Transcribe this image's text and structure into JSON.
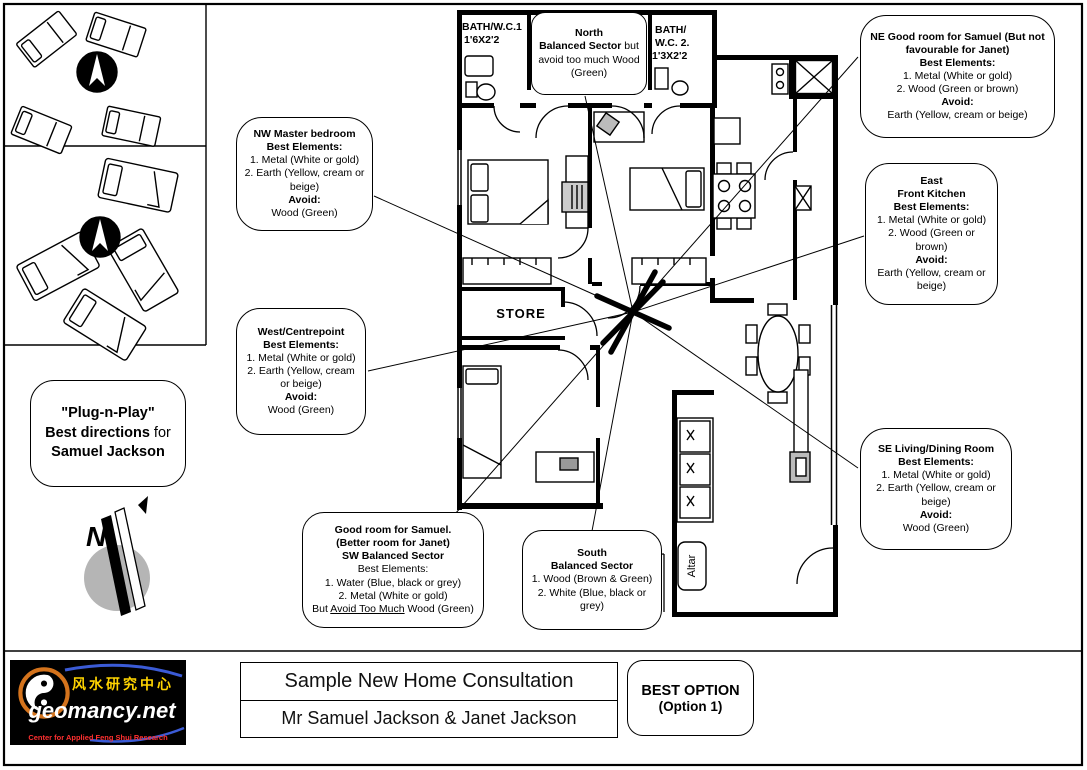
{
  "colors": {
    "line": "#000000",
    "compass_gray": "#b5b5b5",
    "logo_bg": "#000000",
    "logo_yellow": "#ffd400",
    "logo_red": "#ff3030",
    "logo_white": "#ffffff",
    "logo_orange": "#d4731c",
    "logo_blue": "#3b5bd6"
  },
  "left_panel": {
    "plug_quote": "\"Plug-n-Play\"",
    "plug_bold": "Best directions",
    "plug_rest": " for",
    "plug_name": "Samuel Jackson",
    "compass_letter": "N"
  },
  "plan": {
    "bath1_l1": "BATH/W.C.1",
    "bath1_l2": "1'6X2'2",
    "bath2_l1": "BATH/",
    "bath2_l2": "W.C. 2.",
    "bath2_l3": "1'3X2'2",
    "store": "STORE",
    "altar": "Altar"
  },
  "callouts": {
    "nw": {
      "paras": [
        {
          "segs": [
            {
              "t": "NW Master bedroom",
              "b": true
            }
          ]
        },
        {
          "segs": [
            {
              "t": "Best Elements:",
              "b": true
            }
          ]
        },
        {
          "segs": [
            {
              "t": "1. Metal (White or gold)"
            }
          ]
        },
        {
          "segs": [
            {
              "t": "2. Earth (Yellow, cream or beige)"
            }
          ]
        },
        {
          "segs": [
            {
              "t": "Avoid:",
              "b": true
            }
          ]
        },
        {
          "segs": [
            {
              "t": "Wood (Green)"
            }
          ]
        }
      ]
    },
    "north": {
      "paras": [
        {
          "segs": [
            {
              "t": "North",
              "b": true
            }
          ]
        },
        {
          "segs": [
            {
              "t": "Balanced Sector",
              "b": true
            },
            {
              "t": " but avoid too much Wood (Green)"
            }
          ]
        }
      ]
    },
    "ne": {
      "paras": [
        {
          "segs": [
            {
              "t": "NE Good room for Samuel (But not favourable for Janet)",
              "b": true
            }
          ]
        },
        {
          "segs": [
            {
              "t": "Best Elements:",
              "b": true
            }
          ]
        },
        {
          "segs": [
            {
              "t": "1. Metal (White or gold)"
            }
          ]
        },
        {
          "segs": [
            {
              "t": "2. Wood (Green or brown)"
            }
          ]
        },
        {
          "segs": [
            {
              "t": "Avoid:",
              "b": true
            }
          ]
        },
        {
          "segs": [
            {
              "t": "Earth (Yellow, cream or beige)"
            }
          ]
        }
      ]
    },
    "east": {
      "paras": [
        {
          "segs": [
            {
              "t": "East",
              "b": true
            }
          ]
        },
        {
          "segs": [
            {
              "t": "Front Kitchen",
              "b": true
            }
          ]
        },
        {
          "segs": [
            {
              "t": "Best Elements:",
              "b": true
            }
          ]
        },
        {
          "segs": [
            {
              "t": "1. Metal (White or gold)"
            }
          ]
        },
        {
          "segs": [
            {
              "t": "2. Wood (Green or brown)"
            }
          ]
        },
        {
          "segs": [
            {
              "t": "Avoid:",
              "b": true
            }
          ]
        },
        {
          "segs": [
            {
              "t": "Earth (Yellow, cream or beige)"
            }
          ]
        }
      ]
    },
    "west": {
      "paras": [
        {
          "segs": [
            {
              "t": "West/Centrepoint",
              "b": true
            }
          ]
        },
        {
          "segs": [
            {
              "t": "Best Elements:",
              "b": true
            }
          ]
        },
        {
          "segs": [
            {
              "t": "1. Metal (White or gold)"
            }
          ]
        },
        {
          "segs": [
            {
              "t": "2. Earth (Yellow, cream or beige)"
            }
          ]
        },
        {
          "segs": [
            {
              "t": "Avoid:",
              "b": true
            }
          ]
        },
        {
          "segs": [
            {
              "t": "Wood (Green)"
            }
          ]
        }
      ]
    },
    "se": {
      "paras": [
        {
          "segs": [
            {
              "t": "SE Living/Dining Room",
              "b": true
            }
          ]
        },
        {
          "segs": [
            {
              "t": "Best Elements:",
              "b": true
            }
          ]
        },
        {
          "segs": [
            {
              "t": "1. Metal (White or gold)"
            }
          ]
        },
        {
          "segs": [
            {
              "t": "2. Earth (Yellow, cream or beige)"
            }
          ]
        },
        {
          "segs": [
            {
              "t": "Avoid:",
              "b": true
            }
          ]
        },
        {
          "segs": [
            {
              "t": "Wood (Green)"
            }
          ]
        }
      ]
    },
    "sw": {
      "paras": [
        {
          "segs": [
            {
              "t": "Good room for Samuel.",
              "b": true
            }
          ]
        },
        {
          "segs": [
            {
              "t": "(Better room for Janet)",
              "b": true
            }
          ]
        },
        {
          "segs": [
            {
              "t": "SW Balanced Sector",
              "b": true
            }
          ]
        },
        {
          "segs": [
            {
              "t": "Best Elements:"
            }
          ]
        },
        {
          "segs": [
            {
              "t": "1. Water (Blue, black or grey)"
            }
          ]
        },
        {
          "segs": [
            {
              "t": "2. Metal (White or gold)"
            }
          ]
        },
        {
          "segs": [
            {
              "t": "But "
            },
            {
              "t": "Avoid Too Much",
              "u": true
            },
            {
              "t": " Wood (Green)"
            }
          ]
        }
      ]
    },
    "south": {
      "paras": [
        {
          "segs": [
            {
              "t": "South",
              "b": true
            }
          ]
        },
        {
          "segs": [
            {
              "t": "Balanced Sector",
              "b": true
            }
          ]
        },
        {
          "segs": [
            {
              "t": "1. Wood (Brown & Green)"
            }
          ]
        },
        {
          "segs": [
            {
              "t": "2. White (Blue, black or grey)"
            }
          ]
        }
      ]
    }
  },
  "footer": {
    "title": "Sample New Home Consultation",
    "subtitle": "Mr Samuel Jackson & Janet Jackson",
    "best_option_line1": "BEST OPTION",
    "best_option_line2": "(Option 1)",
    "logo": {
      "chinese": "风水研究中心",
      "domain": "geomancy.net",
      "tagline": "Center for Applied Feng Shui Research"
    }
  }
}
